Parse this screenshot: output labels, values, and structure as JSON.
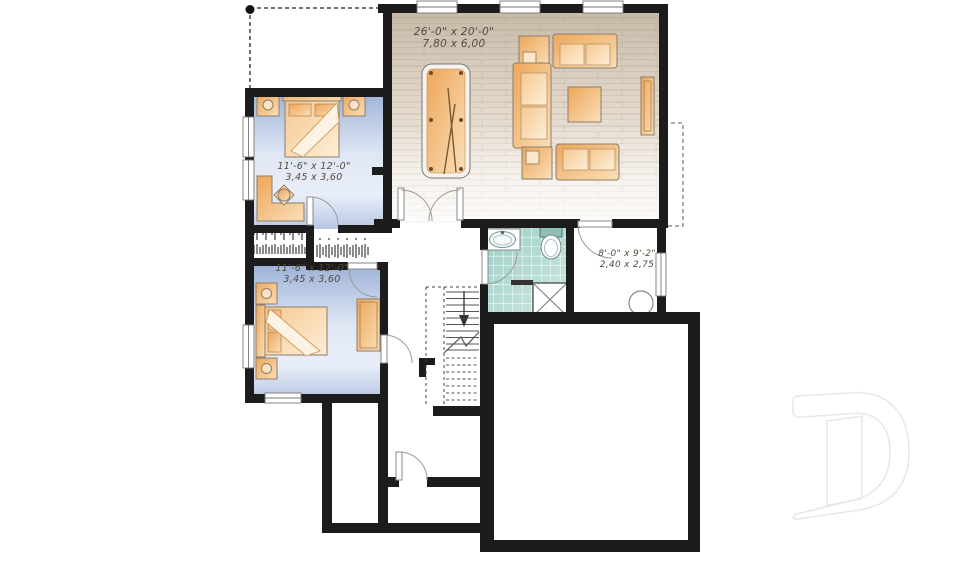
{
  "plan_title": "basement-floor-plan",
  "rooms": {
    "family_room": {
      "imperial": "26'-0\" x 20'-0\"",
      "metric": "7,80 x 6,00"
    },
    "bedroom_top": {
      "imperial": "11'-6\" x 12'-0\"",
      "metric": "3,45 x 3,60"
    },
    "bedroom_bottom": {
      "imperial": "11'-6\" x 12'-0\"",
      "metric": "3,45 x 3,60"
    },
    "utility_room": {
      "imperial": "8'-0\" x 9'-2\"",
      "metric": "2,40 x 2,75"
    }
  },
  "colors": {
    "wall": "#1c1c1c",
    "wood_floor": "#cfc2b2",
    "bedroom_floor": "#a9bcdd",
    "tile_floor": "#a9d6cd",
    "furniture": "#f0ab5e",
    "watermark": "#e7e7e7"
  },
  "icons": {
    "watermark": "drummond-d-logo",
    "stairs_direction": "down-arrow"
  }
}
